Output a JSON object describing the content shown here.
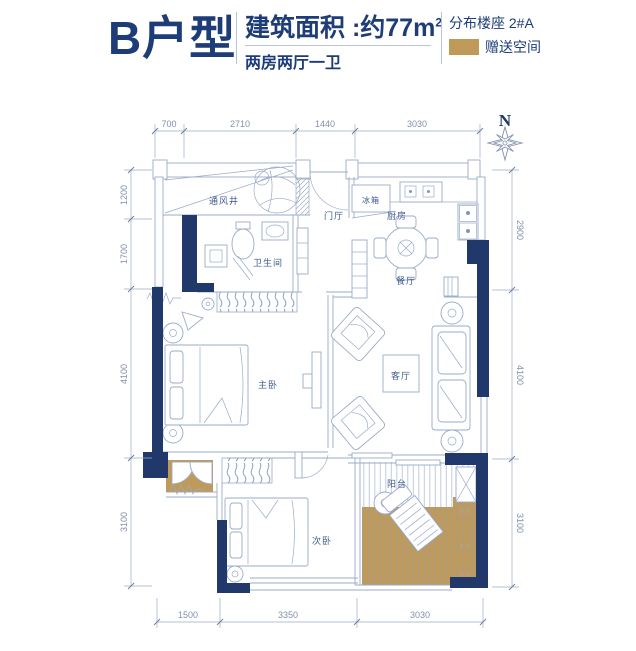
{
  "header": {
    "title": "B户型",
    "area_label": "建筑面积 :约77m",
    "area_sup": "2",
    "layout": "两房两厅一卫",
    "building": "分布楼座 2#A",
    "legend_label": "赠送空间",
    "legend_color": "#bf9a58"
  },
  "compass": {
    "north": "N"
  },
  "plan": {
    "rooms": {
      "vent": "通风井",
      "bath": "卫生间",
      "foyer": "门厅",
      "fridge": "冰箱",
      "kitchen": "厨房",
      "dining": "餐厅",
      "master": "主卧",
      "living": "客厅",
      "second": "次卧",
      "balcony": "阳台"
    },
    "dims_top": [
      "700",
      "2710",
      "1440",
      "3030"
    ],
    "dims_bottom": [
      "1500",
      "3350",
      "3030"
    ],
    "dims_left": [
      "1200",
      "1700",
      "4100",
      "3100"
    ],
    "dims_right": [
      "2900",
      "4100",
      "3100"
    ],
    "colors": {
      "wall": "#21386b",
      "line": "#9aabc8",
      "gift": "#bf9a58",
      "label": "#3c5a8c",
      "dim": "#8290ac"
    }
  }
}
